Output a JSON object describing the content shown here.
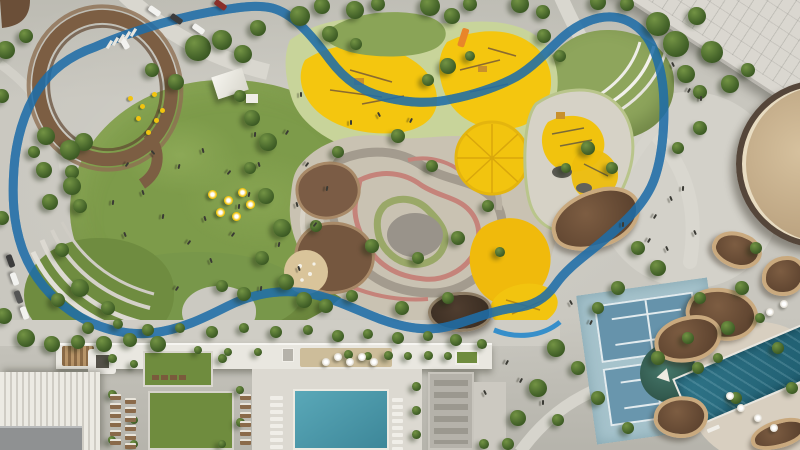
{
  "scene": {
    "type": "aerial-architectural-render",
    "description": "Top-down aerial rendering of a park masterplan: a blue looping cycle track encircles a great lawn, a terraced adventure playground with yellow play surfaces, a spiral lookout pavilion, shade canopies, tennis courts, swimming pools and surrounding residential buildings",
    "elements": [
      {
        "name": "cycle-track-loop",
        "color": "#2e8bca"
      },
      {
        "name": "great-lawn",
        "color": "#7d9b4a"
      },
      {
        "name": "lawn-terrace-steps",
        "color": "#dcd9d1"
      },
      {
        "name": "amphitheater-steps",
        "color": "#f0efe9"
      },
      {
        "name": "playground-yellow-surface",
        "color": "#f4c60f"
      },
      {
        "name": "playground-safety-surface",
        "color": "#c8d49a"
      },
      {
        "name": "adventure-maze-playground",
        "color": "#c9c2b2"
      },
      {
        "name": "climbing-dome",
        "color": "#f2c40f"
      },
      {
        "name": "sand-pit",
        "color": "#d9c49a"
      },
      {
        "name": "mound-play-hills",
        "color": "#7b5c45"
      },
      {
        "name": "shade-canopy-shells",
        "color": "#6b4e38"
      },
      {
        "name": "sunken-pavilion",
        "color": "#4f3d2f"
      },
      {
        "name": "spiral-lookout-pavilion",
        "color": "#7c5e43"
      },
      {
        "name": "tennis-courts",
        "color": "#6693ab"
      },
      {
        "name": "tennis-court-pad",
        "color": "#a6c3cc"
      },
      {
        "name": "residential-pool",
        "color": "#4f9fb0"
      },
      {
        "name": "lap-pool",
        "color": "#2d7085"
      },
      {
        "name": "shade-pond",
        "color": "#3a6459"
      },
      {
        "name": "event-lawn-tent",
        "color": "#f1efe9"
      },
      {
        "name": "tree-canopy",
        "color": "#49682c"
      },
      {
        "name": "paths-pavement",
        "color": "#cbc9c1"
      },
      {
        "name": "roof-building-northeast",
        "color": "#dad7d0"
      },
      {
        "name": "round-tan-building",
        "color": "#c9b290"
      },
      {
        "name": "residential-slab-roof",
        "color": "#e9e7e0"
      },
      {
        "name": "courtyard-lawns",
        "color": "#6f8c3e"
      }
    ]
  },
  "palette": {
    "pavement": "#c8c6be",
    "pavement_light": "#d8d6ce",
    "lawn": "#7d9b4a",
    "lawn_dark": "#60793a",
    "track_blue": "#2e8bca",
    "play_yellow": "#f4c60f",
    "safety_sage": "#c8d49a",
    "maze_base": "#c9c2b2",
    "mound_brown": "#7b5c45",
    "canopy_brown": "#6b4e38",
    "canopy_rim": "#c9a97e",
    "pool_teal": "#4f9fb0",
    "lap_pool_teal": "#2d7085",
    "court_blue": "#6693ab",
    "court_pad": "#a6c3cc",
    "roof_white": "#e9e7e0",
    "roof_tan": "#c9b290",
    "tree_green": "#49682c"
  }
}
